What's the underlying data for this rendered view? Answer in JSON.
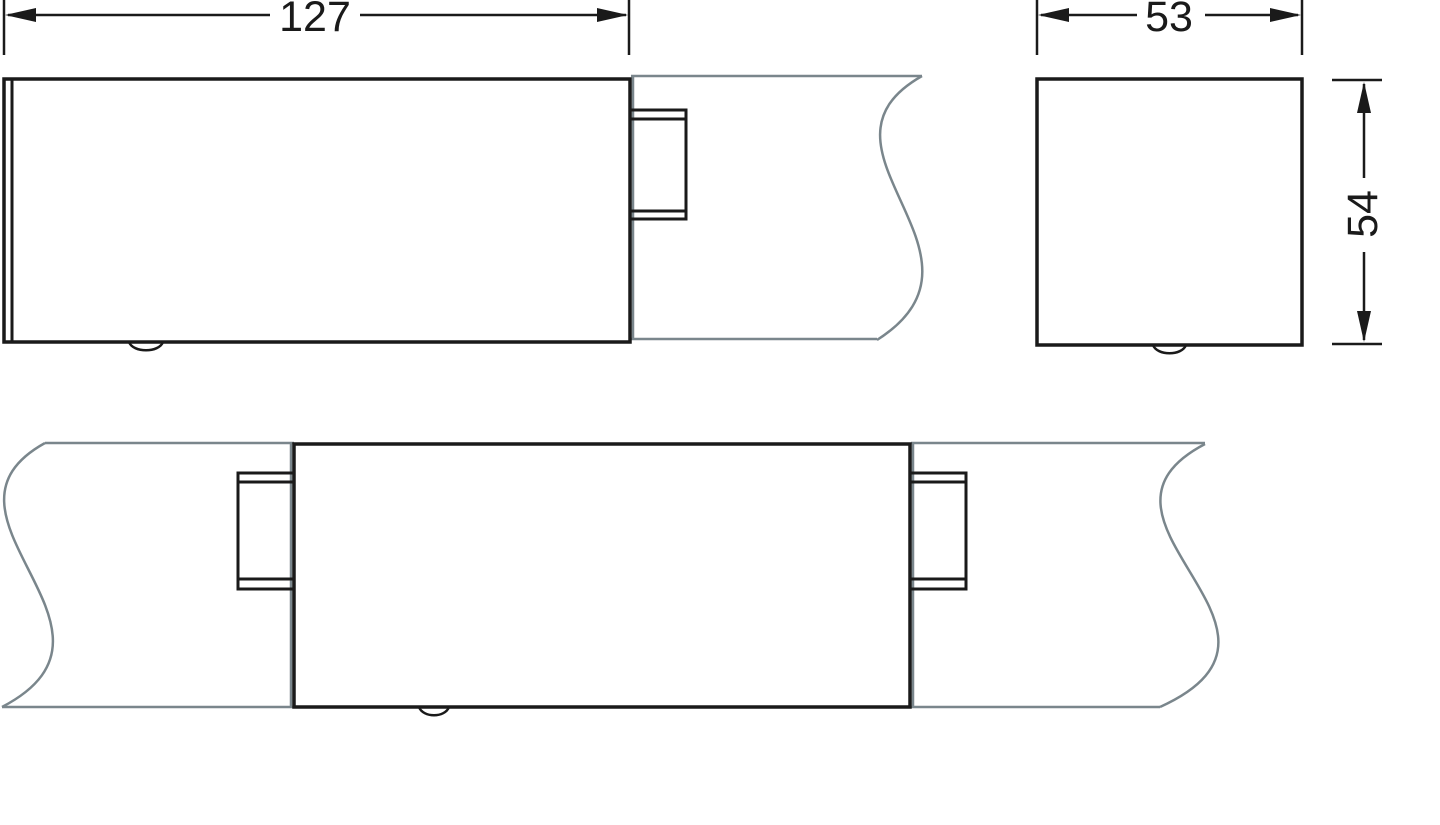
{
  "drawing": {
    "type": "technical-dimension-drawing",
    "background": "#ffffff"
  },
  "colors": {
    "part_outline": "#1a1a1a",
    "duct_line": "#7a868c",
    "dimension": "#1a1a1a"
  },
  "dimensions": {
    "length": {
      "value": "127"
    },
    "width": {
      "value": "53"
    },
    "height": {
      "value": "54"
    }
  }
}
